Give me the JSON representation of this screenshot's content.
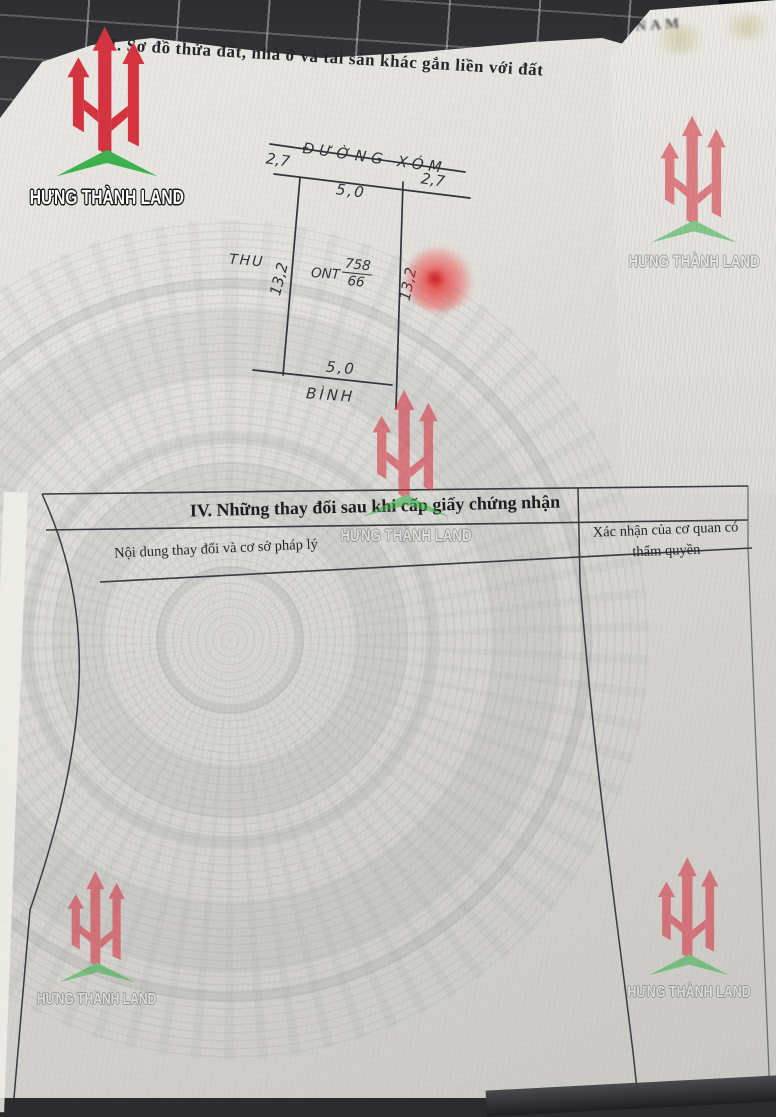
{
  "section3": {
    "title": "III. Sơ đồ thửa đất, nhà ở và tài sản khác gắn liền với đất"
  },
  "behind_sheet": {
    "text_fragment": "Ô  NAM"
  },
  "diagram": {
    "road_dim_left": "2,7",
    "road_name": "ĐƯỜNG XÓM",
    "road_dim_right": "2,7",
    "top_edge": "5,0",
    "left_neighbor": "THU",
    "left_edge": "13,2",
    "land_use_code": "ONT",
    "plot_number": "758",
    "plot_area": "66",
    "right_edge": "13,2",
    "bottom_edge": "5,0",
    "bottom_neighbor": "BÌNH"
  },
  "section4": {
    "title": "IV. Những thay đổi sau khi cấp giấy chứng nhận",
    "col1_header": "Nội dung thay đổi và cơ sở pháp lý",
    "col2_header": "Xác nhận của cơ quan có thẩm quyền"
  },
  "watermark": {
    "text": "HƯNG THÀNH LAND",
    "red": "#d43440",
    "green": "#3db24c"
  }
}
